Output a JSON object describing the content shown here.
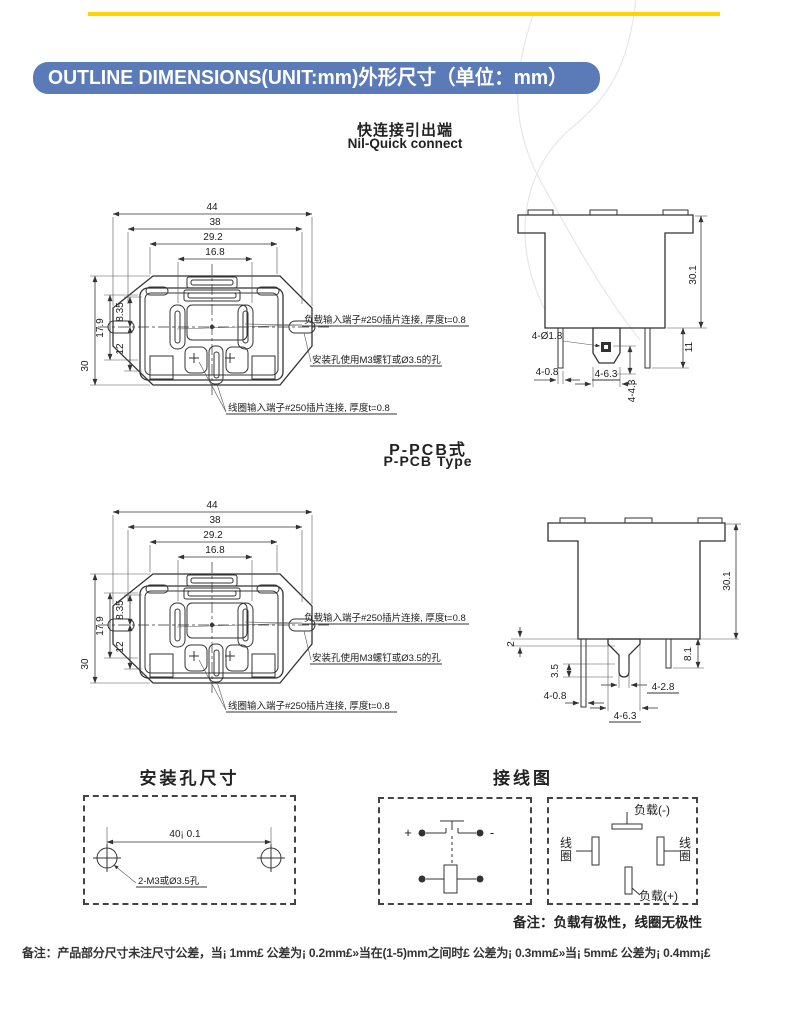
{
  "page": {
    "banner": "OUTLINE DIMENSIONS(UNIT:mm)外形尺寸（单位：mm）",
    "colors": {
      "banner_blue": "#5b7ab8",
      "accent_yellow": "#ffd400"
    },
    "footer_note": "备注：产品部分尺寸未注尺寸公差，当¡ 1mm£ 公差为¡ 0.2mm£»当在(1-5)mm之间时£ 公差为¡ 0.3mm£»当¡ 5mm£ 公差为¡ 0.4mm¡£"
  },
  "quick": {
    "title_zh": "快连接引出端",
    "title_en": "Nil-Quick connect",
    "bottom": {
      "dim_44": "44",
      "dim_38": "38",
      "dim_29_2": "29.2",
      "dim_16_8": "16.8",
      "dim_30": "30",
      "dim_17_9": "17.9",
      "dim_8_35": "8.35",
      "dim_12": "12",
      "callout_load": "负载输入端子#250插片连接, 厚度t=0.8",
      "callout_mount": "安装孔使用M3螺钉或Ø3.5的孔",
      "callout_coil": "线圈输入端子#250插片连接, 厚度t=0.8"
    },
    "side": {
      "dim_30_1": "30.1",
      "dim_11": "11",
      "callout_hole": "4-Ø1.8",
      "dim_4_0_8": "4-0.8",
      "dim_4_6_3": "4-6.3",
      "dim_4_4_3": "4-4.3"
    }
  },
  "pcb": {
    "title_zh": "P-PCB式",
    "title_en": "P-PCB Type",
    "bottom": {
      "dim_44": "44",
      "dim_38": "38",
      "dim_29_2": "29.2",
      "dim_16_8": "16.8",
      "dim_30": "30",
      "dim_17_9": "17.9",
      "dim_8_35": "8.35",
      "dim_12": "12",
      "callout_load": "负载输入端子#250插片连接, 厚度t=0.8",
      "callout_mount": "安装孔使用M3螺钉或Ø3.5的孔",
      "callout_coil": "线圈输入端子#250插片连接, 厚度t=0.8"
    },
    "side": {
      "dim_30_1": "30.1",
      "dim_2": "2",
      "dim_3_5": "3.5",
      "dim_8_1": "8.1",
      "dim_4_0_8": "4-0.8",
      "dim_4_2_8": "4-2.8",
      "dim_4_6_3": "4-6.3"
    }
  },
  "mounting": {
    "title": "安装孔尺寸",
    "dim_40": "40¡ 0.1",
    "callout": "2-M3或Ø3.5孔"
  },
  "wiring": {
    "title": "接线图",
    "plus": "+",
    "minus": "-",
    "load_neg": "负载(-)",
    "load_pos": "负载(+)",
    "coil_left": "线圈",
    "coil_right": "线圈",
    "note": "备注：负载有极性，线圈无极性"
  }
}
